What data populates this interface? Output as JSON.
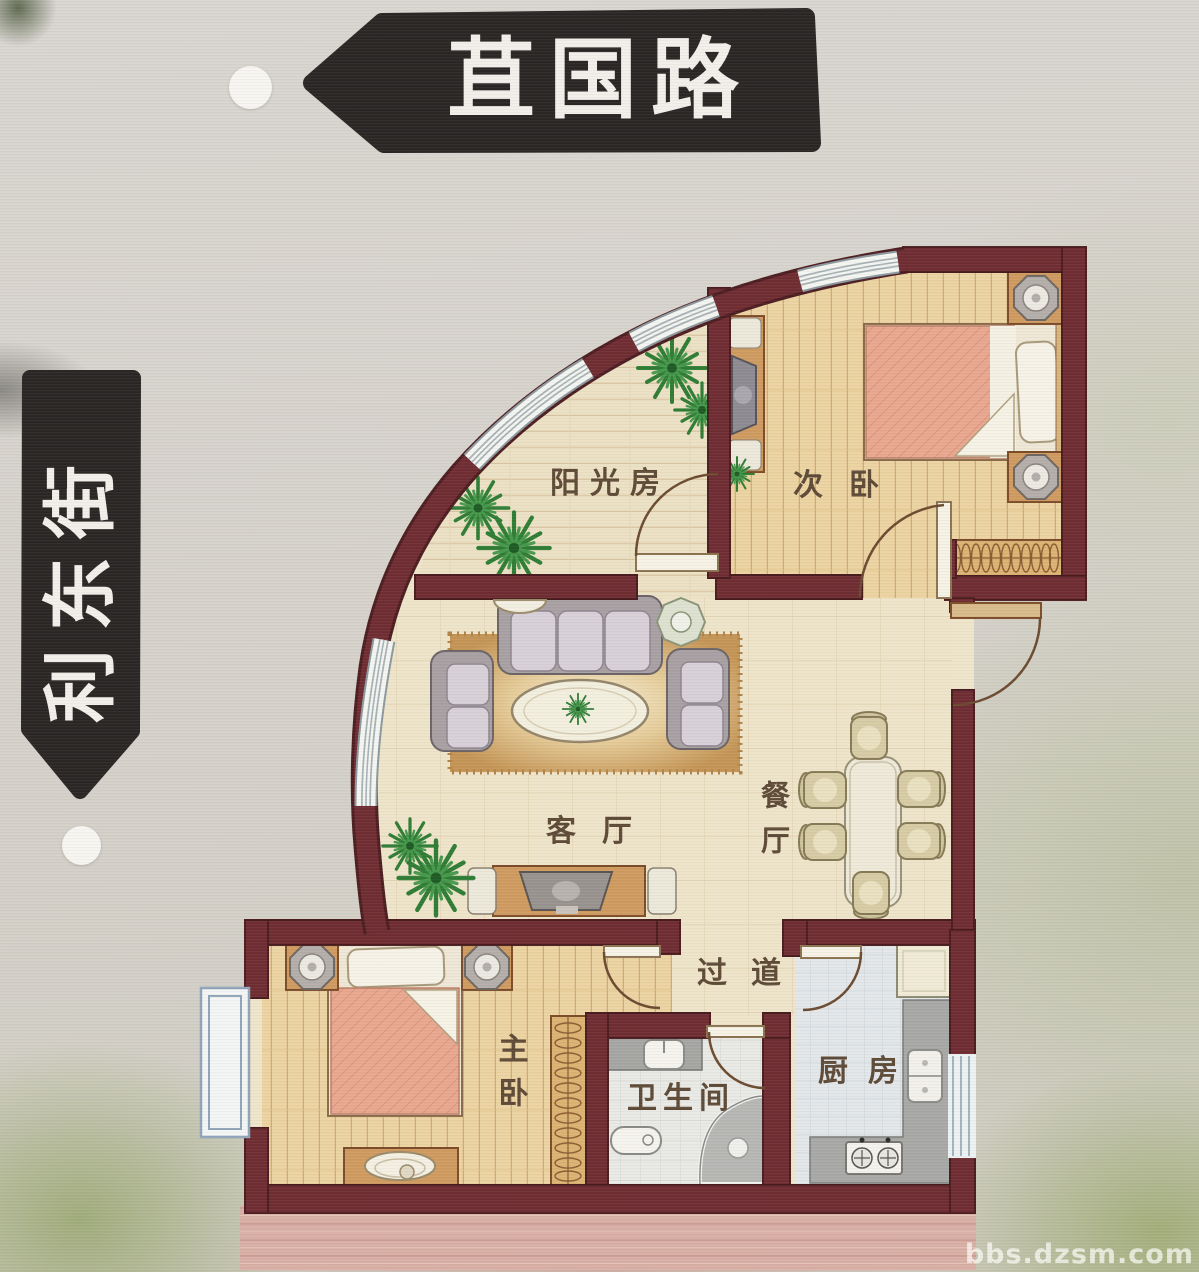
{
  "roads": {
    "top": "苴国路",
    "left": "利东街"
  },
  "rooms": {
    "sunroom": "阳光房",
    "second_bedroom": "次卧",
    "living_room": "客厅",
    "dining_room": "餐厅",
    "hallway": "过道",
    "master_bedroom": "主卧",
    "bathroom": "卫生间",
    "kitchen": "厨房"
  },
  "watermark": "bbs.dzsm.com",
  "palette": {
    "wall": "#6e2b31",
    "wall_outline": "#4a1b1e",
    "banner": "#282524",
    "banner_text": "#f2efeb",
    "floor_cream": "#eee4ca",
    "floor_wood": "#ecd3a2",
    "glass": "#f4f5f1",
    "bed_accent": "#e9a78f",
    "plant": "#2e7c34",
    "label_text": "#5d4936"
  }
}
